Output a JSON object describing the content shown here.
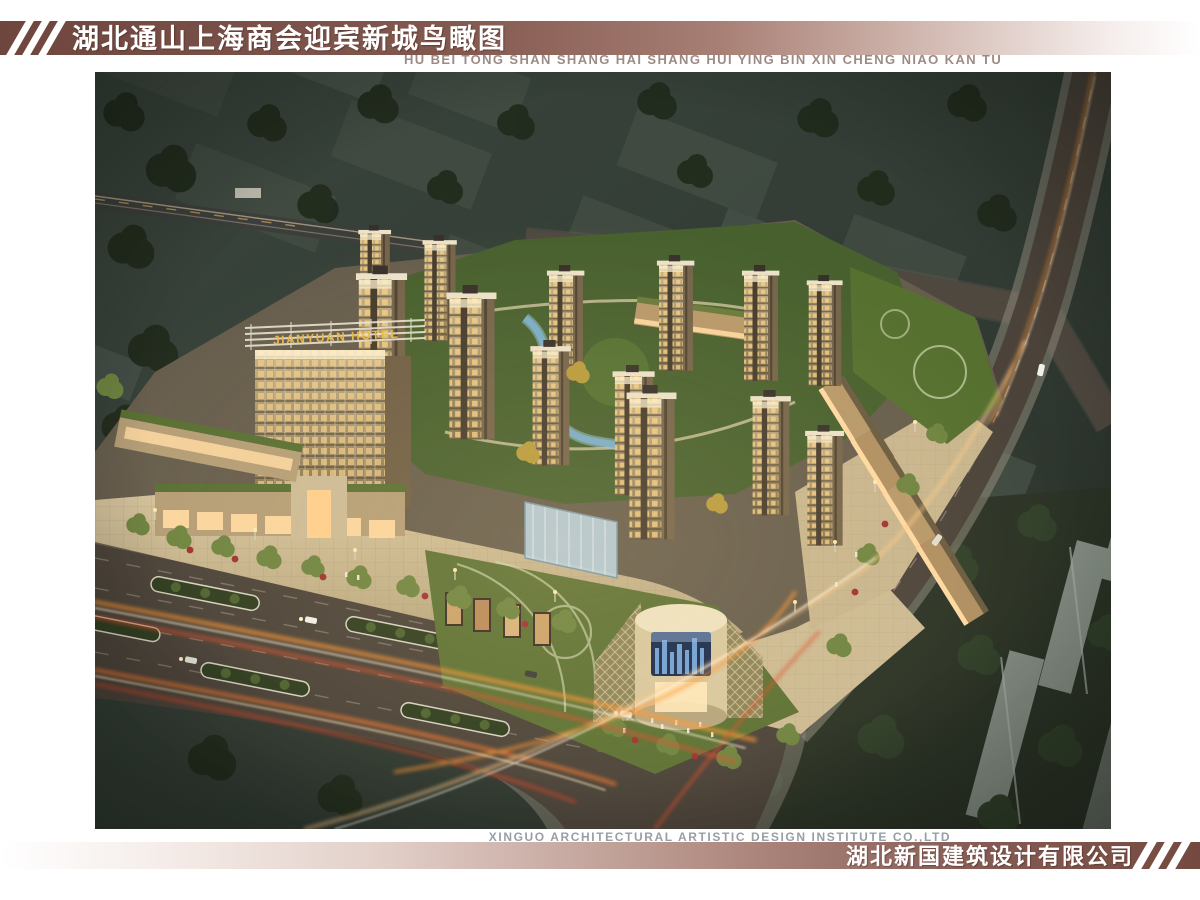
{
  "header": {
    "title_cn": "湖北通山上海商会迎宾新城鸟瞰图",
    "subtitle_pinyin": "HU BEI TONG SHAN SHANG HAI SHANG HUI YING BIN XIN CHENG NIAO KAN TU"
  },
  "footer": {
    "credit_en": "XINGUO ARCHITECTURAL ARTISTIC DESIGN INSTITUTE CO.,LTD",
    "company_cn": "湖北新国建筑设计有限公司"
  },
  "rendering": {
    "hotel_sign": "JIANYUAN HOTEL",
    "description": "Night-time aerial bird's-eye rendering of the Yingbin New Town mixed-use development: residential towers, hotel, commercial mall with round glass drum, landscaped courtyard, boulevards with light trails",
    "colors": {
      "band_maroon": "#744a40",
      "band_light": "#e9dcd8",
      "pinyin_gray": "#9c8b85",
      "credit_gray": "#979ea6",
      "tower_beige": "#b7a47e",
      "roof_green": "#5c7134",
      "road_dark": "#4a423a",
      "trail_orange": "#ff9636",
      "context_green": "#333d34"
    }
  }
}
